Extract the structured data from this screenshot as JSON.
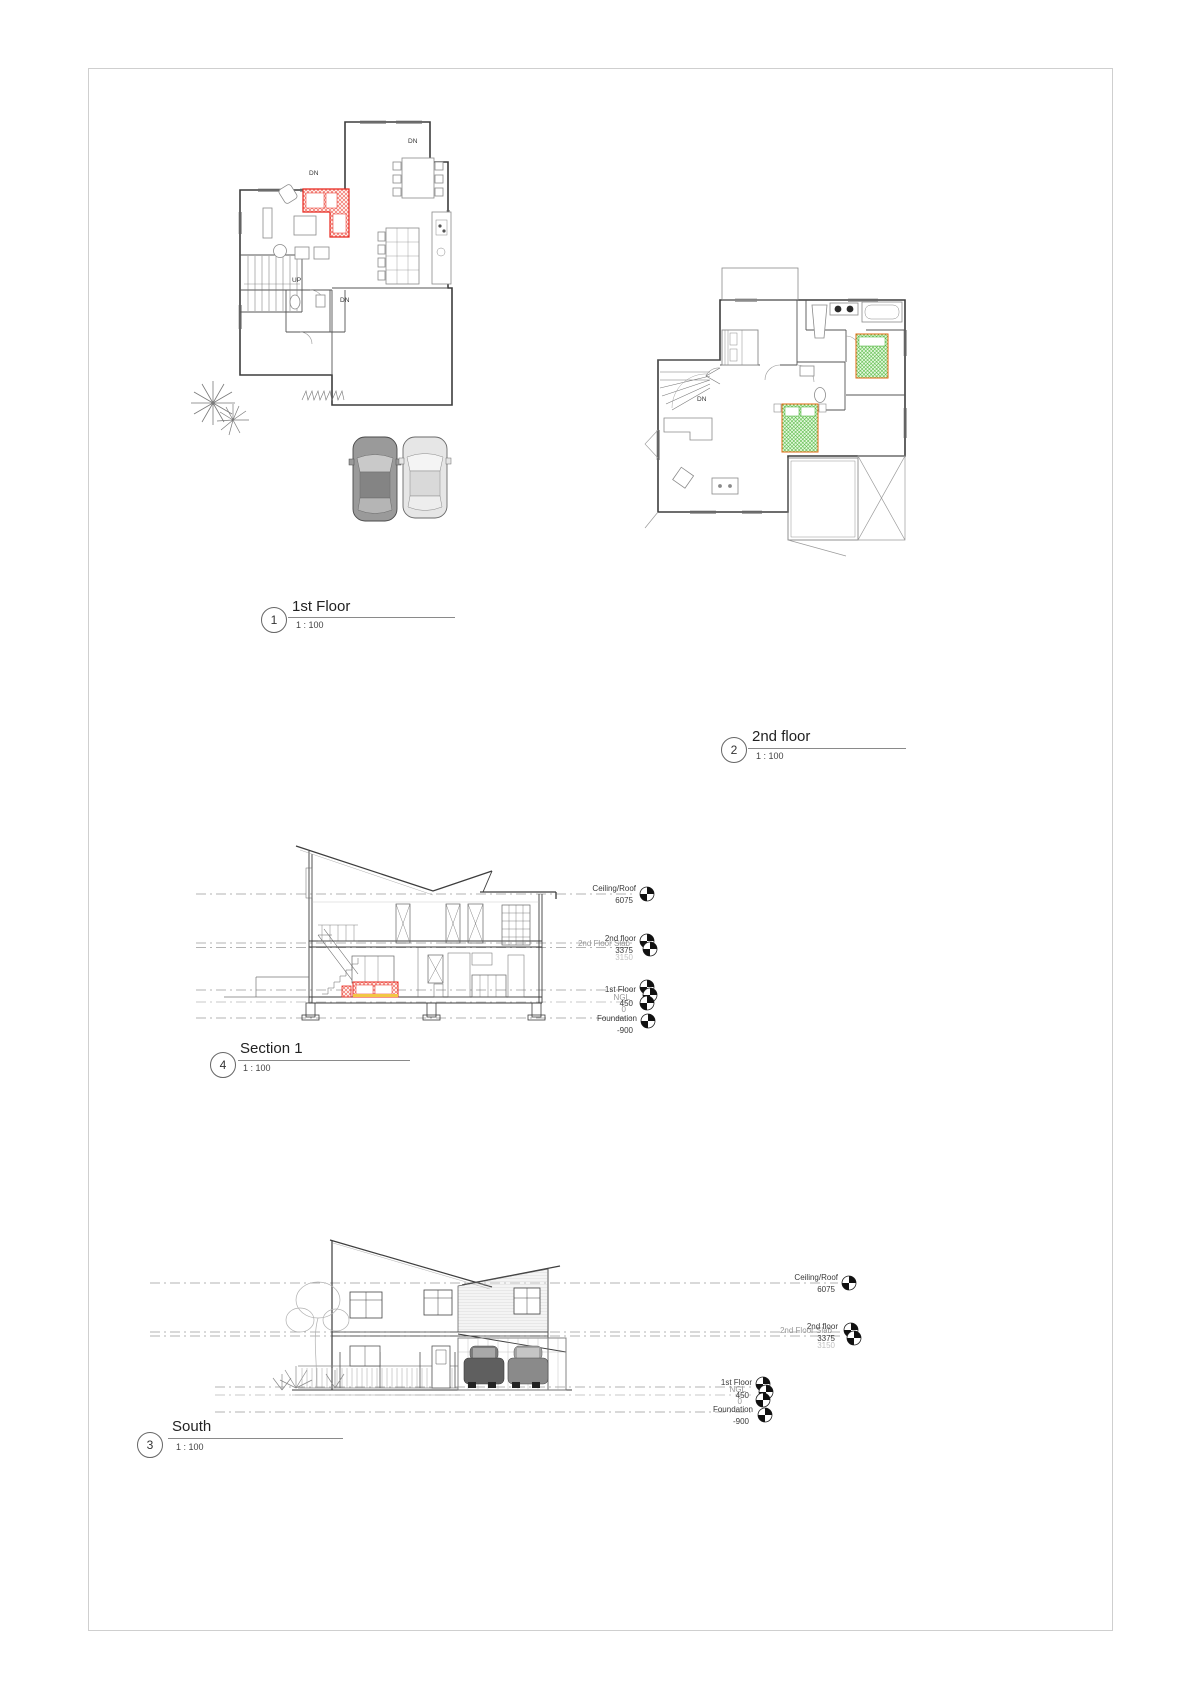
{
  "sheet": {
    "background": "#ffffff",
    "border_color": "#cfcfcf"
  },
  "palette": {
    "wall_line": "#3d3d3d",
    "furniture_line": "#8a8a8a",
    "level_line": "#9b9b9b",
    "text": "#3a3a3a",
    "muted_text": "#979797",
    "highlight_red": "#e8261c",
    "highlight_red_fill": "#fdeae6",
    "highlight_green": "#3fae2a",
    "highlight_green_fill": "#eafbe4",
    "accent_yellow": "#f2c744"
  },
  "views": {
    "first_floor": {
      "number": "1",
      "title": "1st Floor",
      "scale": "1 : 100"
    },
    "second_floor": {
      "number": "2",
      "title": "2nd floor",
      "scale": "1 : 100"
    },
    "south": {
      "number": "3",
      "title": "South",
      "scale": "1 : 100"
    },
    "section": {
      "number": "4",
      "title": "Section 1",
      "scale": "1 : 100"
    }
  },
  "annotations": {
    "first_floor": {
      "entry_dn": "DN",
      "deck_dn": "DN",
      "garage_dn": "DN",
      "stairs_up": "UP"
    },
    "second_floor": {
      "stairs_dn": "DN"
    }
  },
  "levels": {
    "section": {
      "ceiling": {
        "label": "Ceiling/Roof",
        "value": "6075"
      },
      "floor2": {
        "label": "2nd floor",
        "value": "3375"
      },
      "slab2": {
        "label": "2nd Floor Slab",
        "value": "3150"
      },
      "floor1": {
        "label": "1st Floor",
        "value": "450"
      },
      "ngl": {
        "label": "NGL",
        "value": "0"
      },
      "foundation": {
        "label": "Foundation",
        "value": "-900"
      }
    },
    "south": {
      "ceiling": {
        "label": "Ceiling/Roof",
        "value": "6075"
      },
      "floor2": {
        "label": "2nd floor",
        "value": "3375"
      },
      "slab2": {
        "label": "2nd Floor Slab",
        "value": "3150"
      },
      "floor1": {
        "label": "1st Floor",
        "value": "450"
      },
      "ngl": {
        "label": "NGL",
        "value": "0"
      },
      "foundation": {
        "label": "Foundation",
        "value": "-900"
      }
    }
  }
}
